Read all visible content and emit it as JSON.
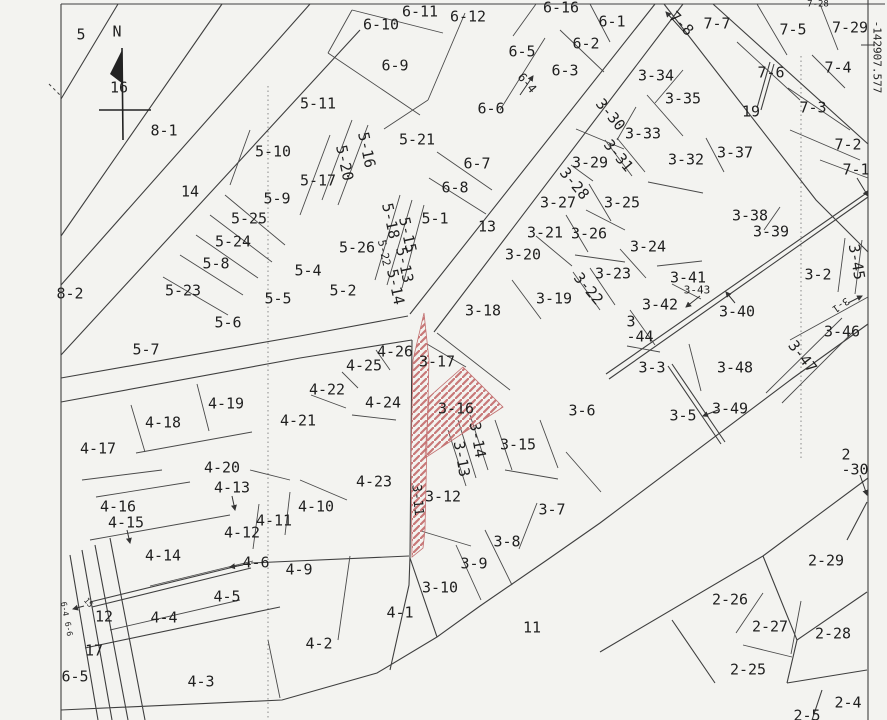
{
  "map": {
    "type": "cadastral-parcel-map",
    "coordinate_label": "-142907.577",
    "north_label": "N",
    "colors": {
      "background": "#f3f3f0",
      "line": "#3f3f3f",
      "hatch": "#c87878",
      "label": "#1f1f1f",
      "dotted": "#8a8a8a"
    },
    "highlighted_parcels": [
      "3-16",
      "3-11"
    ],
    "labels": [
      {
        "t": "5",
        "x": 81,
        "y": 35
      },
      {
        "t": "N",
        "x": 117,
        "y": 32
      },
      {
        "t": "16",
        "x": 119,
        "y": 88
      },
      {
        "t": "8-1",
        "x": 164,
        "y": 131
      },
      {
        "t": "14",
        "x": 190,
        "y": 192
      },
      {
        "t": "8-2",
        "x": 70,
        "y": 294
      },
      {
        "t": "5-11",
        "x": 318,
        "y": 104
      },
      {
        "t": "5-10",
        "x": 273,
        "y": 152
      },
      {
        "t": "5-17",
        "x": 318,
        "y": 181
      },
      {
        "t": "5-16",
        "x": 366,
        "y": 150,
        "r": 78
      },
      {
        "t": "5-20",
        "x": 344,
        "y": 163,
        "r": 78
      },
      {
        "t": "5-9",
        "x": 277,
        "y": 199
      },
      {
        "t": "5-25",
        "x": 249,
        "y": 219
      },
      {
        "t": "5-24",
        "x": 233,
        "y": 242
      },
      {
        "t": "5-8",
        "x": 216,
        "y": 264
      },
      {
        "t": "5-23",
        "x": 183,
        "y": 291
      },
      {
        "t": "5-5",
        "x": 278,
        "y": 299
      },
      {
        "t": "5-6",
        "x": 228,
        "y": 323
      },
      {
        "t": "5-7",
        "x": 146,
        "y": 350
      },
      {
        "t": "5-21",
        "x": 417,
        "y": 140
      },
      {
        "t": "5-1",
        "x": 435,
        "y": 219
      },
      {
        "t": "5-26",
        "x": 357,
        "y": 248
      },
      {
        "t": "5-18",
        "x": 390,
        "y": 221,
        "r": 78
      },
      {
        "t": "5-15",
        "x": 407,
        "y": 235,
        "r": 78
      },
      {
        "t": "5-22",
        "x": 384,
        "y": 253,
        "r": 78,
        "s": 11
      },
      {
        "t": "5-13",
        "x": 404,
        "y": 265,
        "r": 78
      },
      {
        "t": "5-14",
        "x": 395,
        "y": 287,
        "r": 78
      },
      {
        "t": "5-4",
        "x": 308,
        "y": 271
      },
      {
        "t": "5-2",
        "x": 343,
        "y": 291
      },
      {
        "t": "6-11",
        "x": 420,
        "y": 12
      },
      {
        "t": "6-10",
        "x": 381,
        "y": 25
      },
      {
        "t": "6-12",
        "x": 468,
        "y": 17
      },
      {
        "t": "6-16",
        "x": 561,
        "y": 8
      },
      {
        "t": "6-9",
        "x": 395,
        "y": 66
      },
      {
        "t": "6-6",
        "x": 491,
        "y": 109
      },
      {
        "t": "6-5",
        "x": 522,
        "y": 52
      },
      {
        "t": "6-3",
        "x": 565,
        "y": 71
      },
      {
        "t": "6-4",
        "x": 527,
        "y": 83,
        "r": 50,
        "s": 12
      },
      {
        "t": "6-2",
        "x": 586,
        "y": 44
      },
      {
        "t": "6-1",
        "x": 612,
        "y": 22
      },
      {
        "t": "6-7",
        "x": 477,
        "y": 164
      },
      {
        "t": "6-8",
        "x": 455,
        "y": 188
      },
      {
        "t": "13",
        "x": 487,
        "y": 227
      },
      {
        "t": "7-8",
        "x": 681,
        "y": 24,
        "r": 45
      },
      {
        "t": "7-7",
        "x": 717,
        "y": 24
      },
      {
        "t": "7-28",
        "x": 818,
        "y": 5,
        "s": 9
      },
      {
        "t": "7-5",
        "x": 793,
        "y": 30
      },
      {
        "t": "7-29",
        "x": 850,
        "y": 28
      },
      {
        "t": "7-6",
        "x": 771,
        "y": 73
      },
      {
        "t": "7-4",
        "x": 838,
        "y": 68
      },
      {
        "t": "7-3",
        "x": 813,
        "y": 108
      },
      {
        "t": "7-2",
        "x": 848,
        "y": 145
      },
      {
        "t": "7-1",
        "x": 856,
        "y": 170
      },
      {
        "t": "19",
        "x": 751,
        "y": 112
      },
      {
        "t": "3-34",
        "x": 656,
        "y": 76
      },
      {
        "t": "3-35",
        "x": 683,
        "y": 99
      },
      {
        "t": "3-30",
        "x": 610,
        "y": 115,
        "r": 50
      },
      {
        "t": "3-33",
        "x": 643,
        "y": 134
      },
      {
        "t": "3-31",
        "x": 618,
        "y": 156,
        "r": 50
      },
      {
        "t": "3-32",
        "x": 686,
        "y": 160
      },
      {
        "t": "3-37",
        "x": 735,
        "y": 153
      },
      {
        "t": "3-29",
        "x": 590,
        "y": 163
      },
      {
        "t": "3-28",
        "x": 574,
        "y": 184,
        "r": 50
      },
      {
        "t": "3-27",
        "x": 558,
        "y": 203
      },
      {
        "t": "3-25",
        "x": 622,
        "y": 203
      },
      {
        "t": "3-21",
        "x": 545,
        "y": 233
      },
      {
        "t": "3-26",
        "x": 589,
        "y": 234
      },
      {
        "t": "3-24",
        "x": 648,
        "y": 247
      },
      {
        "t": "3-23",
        "x": 613,
        "y": 274
      },
      {
        "t": "3-22",
        "x": 588,
        "y": 289,
        "r": 50
      },
      {
        "t": "3-20",
        "x": 523,
        "y": 255
      },
      {
        "t": "3-19",
        "x": 554,
        "y": 299
      },
      {
        "t": "3-18",
        "x": 483,
        "y": 311
      },
      {
        "t": "3-38",
        "x": 750,
        "y": 216
      },
      {
        "t": "3-39",
        "x": 771,
        "y": 232
      },
      {
        "t": "3-2",
        "x": 818,
        "y": 275
      },
      {
        "t": "3-45",
        "x": 856,
        "y": 262,
        "r": 80
      },
      {
        "t": "3-41",
        "x": 688,
        "y": 278
      },
      {
        "t": "3-43",
        "x": 697,
        "y": 290,
        "s": 11
      },
      {
        "t": "3-42",
        "x": 660,
        "y": 305
      },
      {
        "t": "3-40",
        "x": 737,
        "y": 312
      },
      {
        "t": "3\n-44",
        "x": 640,
        "y": 330
      },
      {
        "t": "3-1",
        "x": 840,
        "y": 304,
        "r": 145,
        "s": 10
      },
      {
        "t": "3-46",
        "x": 842,
        "y": 332
      },
      {
        "t": "3-47",
        "x": 802,
        "y": 357,
        "r": 52
      },
      {
        "t": "3-3",
        "x": 652,
        "y": 368
      },
      {
        "t": "3-48",
        "x": 735,
        "y": 368
      },
      {
        "t": "3-5",
        "x": 683,
        "y": 416
      },
      {
        "t": "3-49",
        "x": 730,
        "y": 409
      },
      {
        "t": "3-6",
        "x": 582,
        "y": 411
      },
      {
        "t": "3-17",
        "x": 437,
        "y": 362
      },
      {
        "t": "3-16",
        "x": 456,
        "y": 409
      },
      {
        "t": "3-14",
        "x": 477,
        "y": 440,
        "r": 80
      },
      {
        "t": "3-13",
        "x": 461,
        "y": 459,
        "r": 80
      },
      {
        "t": "3-15",
        "x": 518,
        "y": 445
      },
      {
        "t": "3-12",
        "x": 443,
        "y": 497
      },
      {
        "t": "3-11",
        "x": 417,
        "y": 500,
        "r": 85,
        "s": 13
      },
      {
        "t": "3-7",
        "x": 552,
        "y": 510
      },
      {
        "t": "3-8",
        "x": 507,
        "y": 542
      },
      {
        "t": "3-9",
        "x": 474,
        "y": 564
      },
      {
        "t": "3-10",
        "x": 440,
        "y": 588
      },
      {
        "t": "11",
        "x": 532,
        "y": 628
      },
      {
        "t": "2\n-30",
        "x": 855,
        "y": 463
      },
      {
        "t": "2-29",
        "x": 826,
        "y": 561
      },
      {
        "t": "2-26",
        "x": 730,
        "y": 600
      },
      {
        "t": "2-27",
        "x": 770,
        "y": 627
      },
      {
        "t": "2-28",
        "x": 833,
        "y": 634
      },
      {
        "t": "2-25",
        "x": 748,
        "y": 670
      },
      {
        "t": "2-4",
        "x": 848,
        "y": 703
      },
      {
        "t": "2-5",
        "x": 807,
        "y": 716
      },
      {
        "t": "4-26",
        "x": 395,
        "y": 352
      },
      {
        "t": "4-25",
        "x": 364,
        "y": 366
      },
      {
        "t": "4-22",
        "x": 327,
        "y": 390
      },
      {
        "t": "4-24",
        "x": 383,
        "y": 403
      },
      {
        "t": "4-21",
        "x": 298,
        "y": 421
      },
      {
        "t": "4-23",
        "x": 374,
        "y": 482
      },
      {
        "t": "4-10",
        "x": 316,
        "y": 507
      },
      {
        "t": "4-19",
        "x": 226,
        "y": 404
      },
      {
        "t": "4-18",
        "x": 163,
        "y": 423
      },
      {
        "t": "4-17",
        "x": 98,
        "y": 449
      },
      {
        "t": "4-20",
        "x": 222,
        "y": 468
      },
      {
        "t": "4-13",
        "x": 232,
        "y": 488
      },
      {
        "t": "4-16",
        "x": 118,
        "y": 507
      },
      {
        "t": "4-15",
        "x": 126,
        "y": 523
      },
      {
        "t": "4-11",
        "x": 274,
        "y": 521
      },
      {
        "t": "4-12",
        "x": 242,
        "y": 533
      },
      {
        "t": "4-14",
        "x": 163,
        "y": 556
      },
      {
        "t": "4-6",
        "x": 256,
        "y": 563
      },
      {
        "t": "4-9",
        "x": 299,
        "y": 570
      },
      {
        "t": "4-5",
        "x": 227,
        "y": 597
      },
      {
        "t": "4-4",
        "x": 164,
        "y": 618
      },
      {
        "t": "4-1",
        "x": 400,
        "y": 613
      },
      {
        "t": "4-2",
        "x": 319,
        "y": 644
      },
      {
        "t": "4-3",
        "x": 201,
        "y": 682
      },
      {
        "t": "12",
        "x": 104,
        "y": 617
      },
      {
        "t": "17",
        "x": 94,
        "y": 651
      },
      {
        "t": "6-5",
        "x": 75,
        "y": 677
      },
      {
        "t": "6-4",
        "x": 64,
        "y": 609,
        "r": 80,
        "s": 8
      },
      {
        "t": "6-6",
        "x": 68,
        "y": 629,
        "r": 80,
        "s": 8
      },
      {
        "t": "15",
        "x": 88,
        "y": 603,
        "r": 50,
        "s": 8
      },
      {
        "t": "-142907.577",
        "x": 877,
        "y": 57,
        "r": 90,
        "s": 11
      }
    ]
  }
}
